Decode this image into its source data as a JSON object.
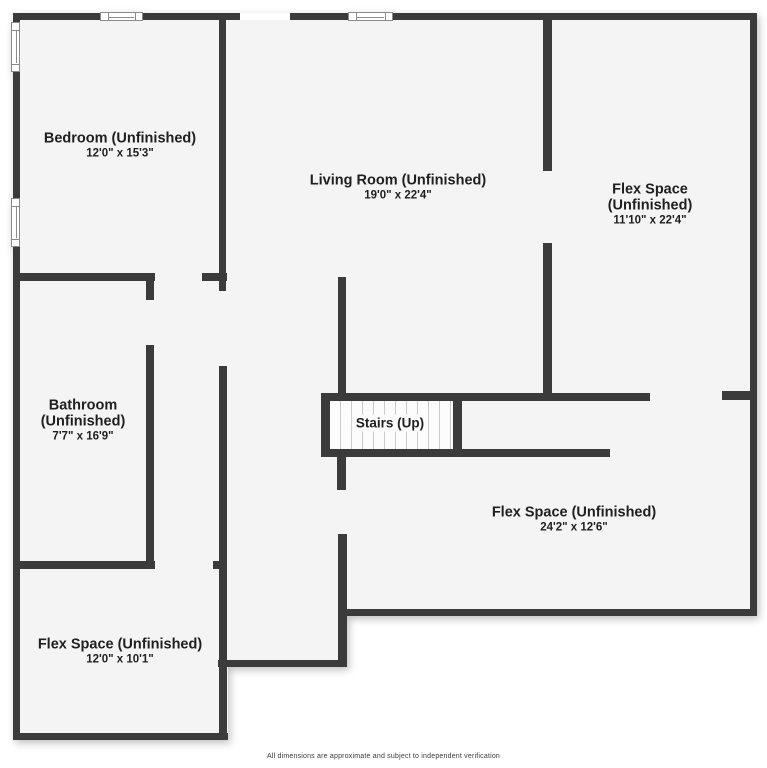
{
  "plan": {
    "colors": {
      "wall": "#3b3b3b",
      "floor": "#f4f4f4",
      "exterior": "#ffffff",
      "window_border": "#8a8a8a",
      "stairs_fill": "#fcfcfc",
      "tread_line": "#c9c9c9",
      "label_text": "#1f1f1f"
    },
    "floors": [
      {
        "name": "floor-main",
        "x": 13,
        "y": 13,
        "w": 744,
        "h": 603
      },
      {
        "name": "floor-lower-left",
        "x": 13,
        "y": 616,
        "w": 215,
        "h": 124
      },
      {
        "name": "floor-lower-mid",
        "x": 228,
        "y": 616,
        "w": 119,
        "h": 51
      }
    ],
    "walls": [
      {
        "name": "exterior-top-wall-a",
        "x": 13,
        "y": 13,
        "w": 87,
        "h": 7
      },
      {
        "name": "exterior-top-wall-b",
        "x": 143,
        "y": 13,
        "w": 97,
        "h": 7
      },
      {
        "name": "exterior-top-wall-c",
        "x": 290,
        "y": 13,
        "w": 58,
        "h": 7
      },
      {
        "name": "exterior-top-wall-d",
        "x": 393,
        "y": 13,
        "w": 364,
        "h": 7
      },
      {
        "name": "exterior-left-wall-a",
        "x": 13,
        "y": 13,
        "w": 7,
        "h": 9
      },
      {
        "name": "exterior-left-wall-b",
        "x": 13,
        "y": 72,
        "w": 7,
        "h": 126
      },
      {
        "name": "exterior-left-wall-c",
        "x": 13,
        "y": 247,
        "w": 7,
        "h": 493
      },
      {
        "name": "exterior-right-wall",
        "x": 750,
        "y": 13,
        "w": 7,
        "h": 603
      },
      {
        "name": "exterior-bottom-wall-main",
        "x": 341,
        "y": 609,
        "w": 416,
        "h": 7
      },
      {
        "name": "exterior-bottom-wall-mid",
        "x": 218,
        "y": 660,
        "w": 129,
        "h": 7
      },
      {
        "name": "exterior-bottom-wall-left",
        "x": 13,
        "y": 733,
        "w": 215,
        "h": 7
      },
      {
        "name": "bedroom-east-wall",
        "x": 219,
        "y": 13,
        "w": 7,
        "h": 278
      },
      {
        "name": "bathroom-north-wall",
        "x": 13,
        "y": 273,
        "w": 142,
        "h": 8
      },
      {
        "name": "bathroom-door-jamb",
        "x": 146,
        "y": 273,
        "w": 8,
        "h": 27
      },
      {
        "name": "hall-north-stub-wall",
        "x": 202,
        "y": 273,
        "w": 25,
        "h": 8
      },
      {
        "name": "bathroom-east-wall",
        "x": 146,
        "y": 345,
        "w": 8,
        "h": 223
      },
      {
        "name": "hall-west-wall",
        "x": 219,
        "y": 366,
        "w": 8,
        "h": 374
      },
      {
        "name": "small-flex-north-wall",
        "x": 13,
        "y": 561,
        "w": 142,
        "h": 8
      },
      {
        "name": "small-flex-north-nub",
        "x": 213,
        "y": 561,
        "w": 14,
        "h": 8
      },
      {
        "name": "living-room-west-wall",
        "x": 338,
        "y": 277,
        "w": 8,
        "h": 116
      },
      {
        "name": "stairs-west-wall",
        "x": 321,
        "y": 393,
        "w": 9,
        "h": 64
      },
      {
        "name": "stairs-north-wall",
        "x": 321,
        "y": 393,
        "w": 329,
        "h": 8
      },
      {
        "name": "stairs-south-wall",
        "x": 321,
        "y": 449,
        "w": 289,
        "h": 8
      },
      {
        "name": "stairs-divider-wall",
        "x": 453,
        "y": 393,
        "w": 9,
        "h": 64
      },
      {
        "name": "east-hall-stub-wall",
        "x": 722,
        "y": 391,
        "w": 35,
        "h": 9
      },
      {
        "name": "flex-divider-wall-north",
        "x": 543,
        "y": 13,
        "w": 9,
        "h": 158
      },
      {
        "name": "flex-divider-wall-south",
        "x": 543,
        "y": 243,
        "w": 9,
        "h": 157
      },
      {
        "name": "understairs-wall-a",
        "x": 337,
        "y": 457,
        "w": 9,
        "h": 33
      },
      {
        "name": "understairs-wall-b",
        "x": 338,
        "y": 534,
        "w": 9,
        "h": 132
      }
    ],
    "openings": [
      {
        "name": "top-wall-opening",
        "x": 240,
        "y": 13,
        "w": 50,
        "h": 7
      }
    ],
    "windows": [
      {
        "name": "window-top-left",
        "x": 100,
        "y": 12,
        "w": 43,
        "h": 9,
        "orient": "h"
      },
      {
        "name": "window-top-right",
        "x": 348,
        "y": 12,
        "w": 45,
        "h": 9,
        "orient": "h"
      },
      {
        "name": "window-left-upper",
        "x": 11,
        "y": 22,
        "w": 9,
        "h": 50,
        "orient": "v"
      },
      {
        "name": "window-left-lower",
        "x": 11,
        "y": 198,
        "w": 9,
        "h": 49,
        "orient": "v"
      }
    ],
    "stairs": {
      "x": 330,
      "y": 401,
      "w": 123,
      "h": 48,
      "tread_spacing": 11,
      "label": "Stairs (Up)",
      "label_cx": 390,
      "label_cy": 423
    },
    "rooms": [
      {
        "id": "bedroom",
        "lines": [
          "Bedroom (Unfinished)"
        ],
        "dims": "12'0\" x 15'3\"",
        "cx": 120,
        "cy": 146
      },
      {
        "id": "living-room",
        "lines": [
          "Living Room (Unfinished)"
        ],
        "dims": "19'0\" x 22'4\"",
        "cx": 398,
        "cy": 188
      },
      {
        "id": "flex-space-right",
        "lines": [
          "Flex Space (Unfinished)"
        ],
        "dims": "11'10\" x 22'4\"",
        "cx": 650,
        "cy": 205
      },
      {
        "id": "bathroom",
        "lines": [
          "Bathroom",
          "(Unfinished)"
        ],
        "dims": "7'7\" x 16'9\"",
        "cx": 83,
        "cy": 421
      },
      {
        "id": "flex-space-lower",
        "lines": [
          "Flex Space (Unfinished)"
        ],
        "dims": "24'2\" x 12'6\"",
        "cx": 574,
        "cy": 520
      },
      {
        "id": "flex-space-small",
        "lines": [
          "Flex Space (Unfinished)"
        ],
        "dims": "12'0\" x 10'1\"",
        "cx": 120,
        "cy": 652
      }
    ]
  },
  "footer": {
    "disclaimer": "All dimensions are approximate and subject to independent verification"
  }
}
